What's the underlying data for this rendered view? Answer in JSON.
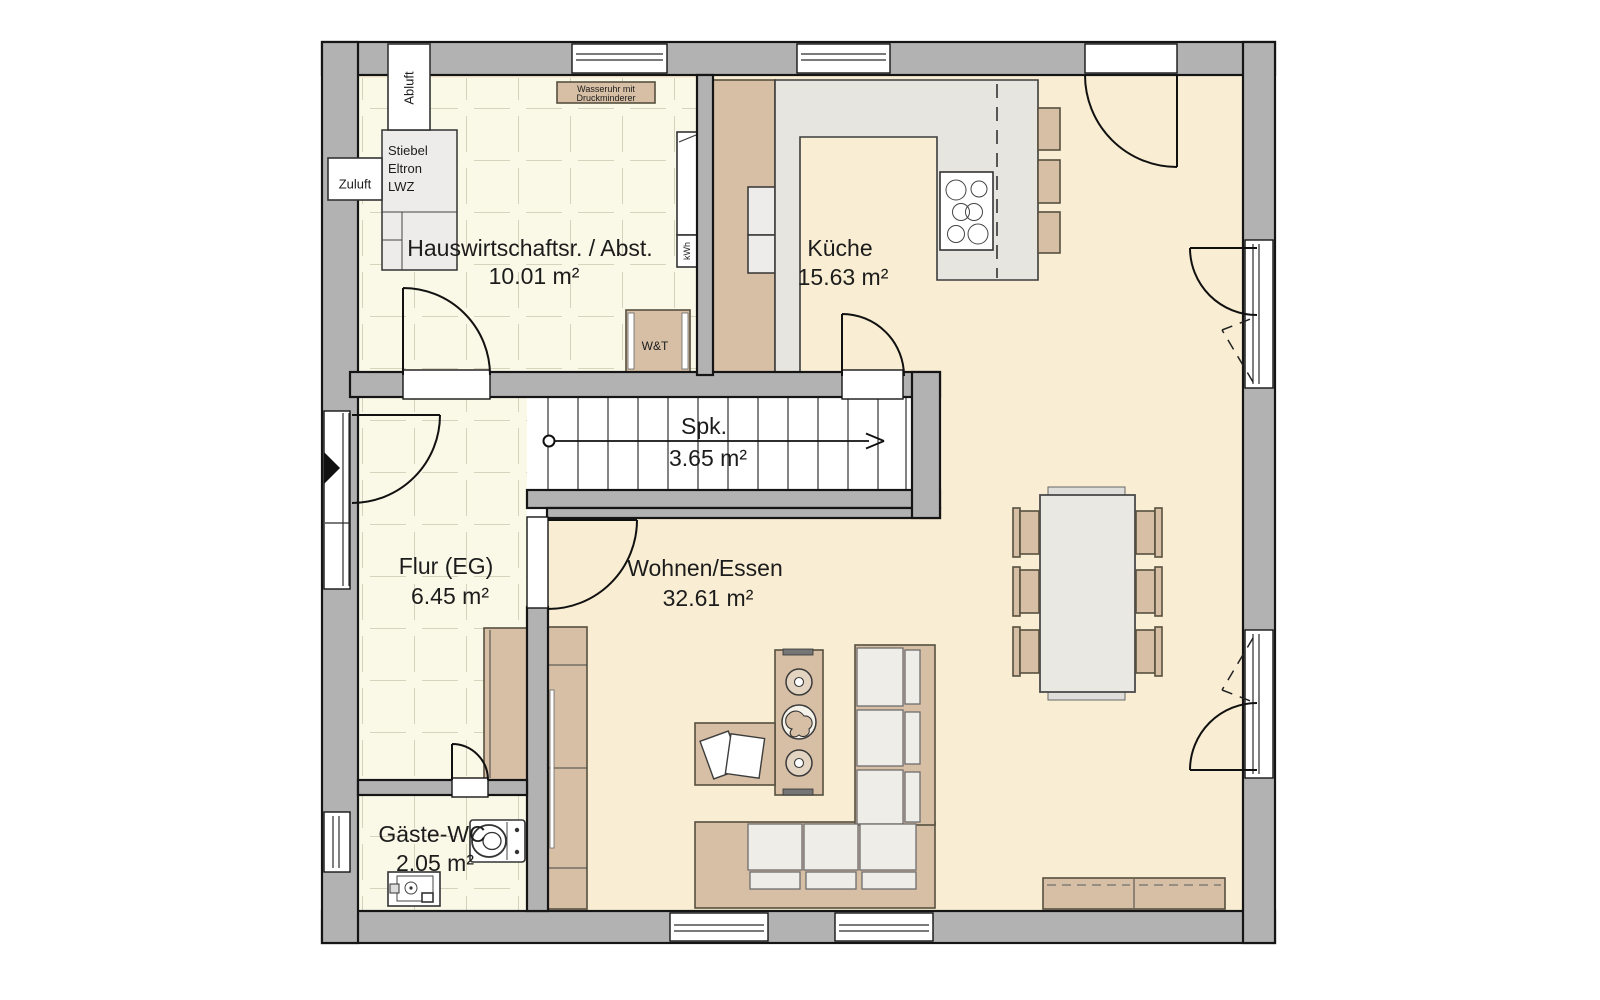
{
  "rooms": [
    {
      "id": "hauswirtschaftsraum",
      "name": "Hauswirtschaftsr. / Abst.",
      "area": "10.01 m²"
    },
    {
      "id": "kueche",
      "name": "Küche",
      "area": "15.63 m²"
    },
    {
      "id": "speisekammer",
      "name": "Spk.",
      "area": "3.65 m²"
    },
    {
      "id": "flur",
      "name": "Flur (EG)",
      "area": "6.45 m²"
    },
    {
      "id": "wohnen_essen",
      "name": "Wohnen/Essen",
      "area": "32.61 m²"
    },
    {
      "id": "gaeste_wc",
      "name": "Gäste-WC",
      "area": "2.05 m²"
    }
  ],
  "annotations": {
    "abluft": "Abluft",
    "zuluft": "Zuluft",
    "heater": [
      "Stiebel",
      "Eltron",
      "LWZ"
    ],
    "water_meter": [
      "Wasseruhr mit",
      "Druckminderer"
    ],
    "washer_dryer": "W&T",
    "electric_meter": "kWh"
  },
  "colors": {
    "background": "#FFFFFF",
    "wall": "#B2B2B2",
    "wall_outline": "#151515",
    "tile_floor": "#FAF8E6",
    "tile_grid": "#C9C8AF",
    "cream_floor": "#F9EED3",
    "counter": "#E7E5E0",
    "wood_furniture": "#D6BFA5",
    "cushion": "#EFEDE8"
  }
}
